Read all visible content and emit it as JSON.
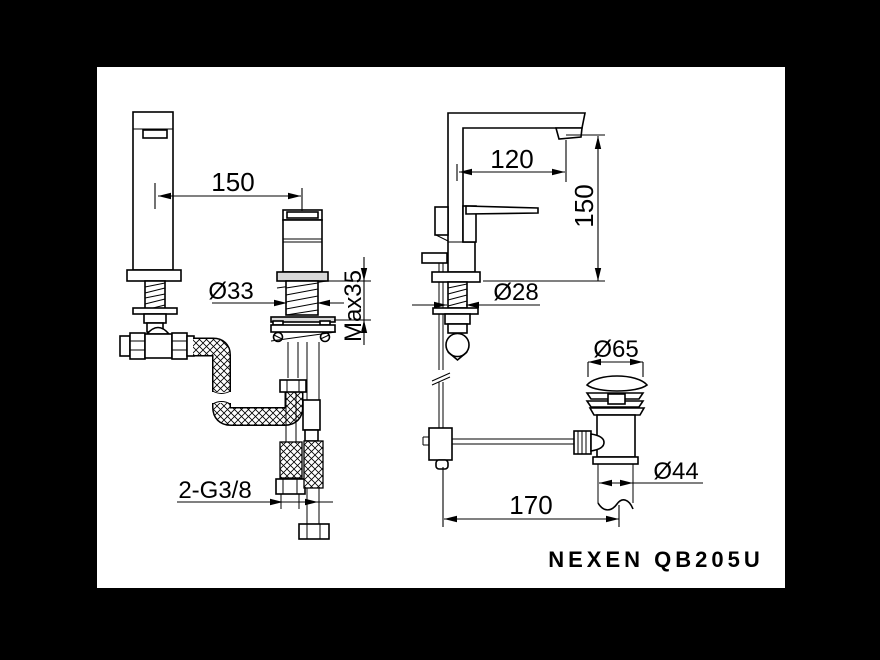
{
  "colors": {
    "background": "#000000",
    "paper": "#ffffff",
    "line": "#000000"
  },
  "product": {
    "name": "NEXEN QB205U"
  },
  "dims": {
    "center_spacing": "150",
    "spout_reach": "120",
    "spout_height": "150",
    "shank_front_dia": "Ø33",
    "max_deck_thickness": "Max35",
    "shank_side_dia": "Ø28",
    "drain_flange_dia": "Ø65",
    "drain_body_dia": "Ø44",
    "inlet_thread": "2-G3/8",
    "rod_to_drain": "170"
  }
}
